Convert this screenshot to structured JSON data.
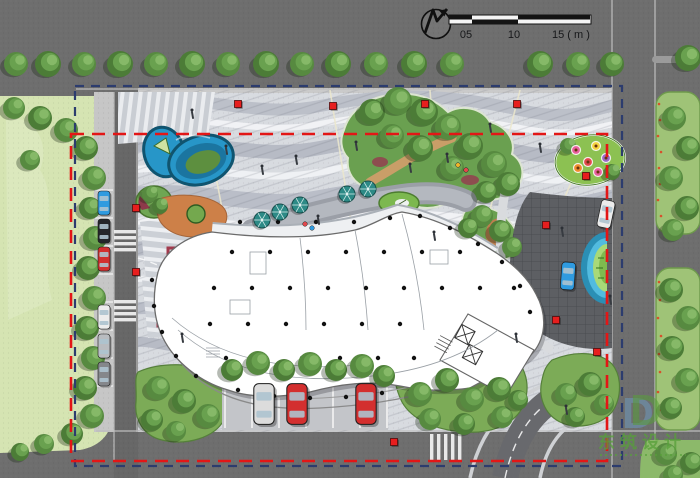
{
  "drawing": {
    "type": "landscape-site-plan-rendering",
    "north_arrow_icon": "stylized-N-arrow",
    "scalebar": {
      "labels": [
        "05",
        "10",
        "15 ( m )"
      ]
    },
    "logo": {
      "monogram": "D",
      "cn": "东筑设计"
    }
  },
  "palette": {
    "asphalt": "#6e6e6e",
    "lawn": "#d5e4b2",
    "plaza": "#d8dbe0",
    "wave_dark": "#b7bbc5",
    "wave_light": "#f1f2f5",
    "tree_green": "#4c7c37",
    "island_green": "#6aa050",
    "pond_blue": "#2796c8",
    "water_blue": "#52bbdf",
    "terracotta": "#cd8048",
    "planter_maroon": "#a23a4d",
    "boundary_red": "#e31616",
    "boundary_navy": "#2c3c6e",
    "marker_red": "#e71e1e",
    "umbrella_teal": "#2d8a86",
    "building_white": "#ffffff",
    "logo_green": "#57a03a",
    "logo_blue": "#6d8ba4"
  },
  "scene": {
    "trees": [
      [
        16,
        64,
        12
      ],
      [
        48,
        64,
        13
      ],
      [
        84,
        64,
        12
      ],
      [
        120,
        64,
        13
      ],
      [
        156,
        64,
        12
      ],
      [
        192,
        64,
        13
      ],
      [
        228,
        64,
        12
      ],
      [
        266,
        64,
        13
      ],
      [
        302,
        64,
        12
      ],
      [
        338,
        64,
        13
      ],
      [
        376,
        64,
        12
      ],
      [
        414,
        64,
        13
      ],
      [
        452,
        64,
        12
      ],
      [
        540,
        64,
        13
      ],
      [
        578,
        64,
        12
      ],
      [
        612,
        64,
        12
      ],
      [
        14,
        108,
        11
      ],
      [
        40,
        118,
        12
      ],
      [
        66,
        130,
        12
      ],
      [
        86,
        148,
        12
      ],
      [
        94,
        178,
        12
      ],
      [
        90,
        208,
        11
      ],
      [
        95,
        238,
        12
      ],
      [
        88,
        268,
        12
      ],
      [
        94,
        298,
        12
      ],
      [
        87,
        328,
        12
      ],
      [
        93,
        358,
        12
      ],
      [
        85,
        388,
        12
      ],
      [
        92,
        416,
        12
      ],
      [
        72,
        434,
        11
      ],
      [
        44,
        444,
        10
      ],
      [
        20,
        452,
        9
      ],
      [
        30,
        160,
        10
      ],
      [
        372,
        112,
        13
      ],
      [
        398,
        101,
        14
      ],
      [
        424,
        112,
        14
      ],
      [
        448,
        127,
        13
      ],
      [
        470,
        146,
        13
      ],
      [
        494,
        164,
        13
      ],
      [
        508,
        184,
        12
      ],
      [
        452,
        168,
        12
      ],
      [
        420,
        148,
        13
      ],
      [
        392,
        136,
        12
      ],
      [
        486,
        192,
        11
      ],
      [
        482,
        216,
        11
      ],
      [
        500,
        231,
        11
      ],
      [
        512,
        247,
        10
      ],
      [
        468,
        228,
        10
      ],
      [
        150,
        194,
        8
      ],
      [
        160,
        206,
        8
      ],
      [
        568,
        146,
        8
      ],
      [
        612,
        172,
        8
      ],
      [
        158,
        388,
        12
      ],
      [
        184,
        401,
        12
      ],
      [
        208,
        416,
        12
      ],
      [
        152,
        420,
        11
      ],
      [
        176,
        431,
        10
      ],
      [
        232,
        370,
        11
      ],
      [
        258,
        363,
        12
      ],
      [
        284,
        370,
        11
      ],
      [
        310,
        364,
        12
      ],
      [
        336,
        370,
        11
      ],
      [
        362,
        366,
        12
      ],
      [
        384,
        376,
        11
      ],
      [
        420,
        394,
        12
      ],
      [
        447,
        380,
        12
      ],
      [
        472,
        399,
        12
      ],
      [
        499,
        389,
        12
      ],
      [
        430,
        419,
        11
      ],
      [
        464,
        424,
        11
      ],
      [
        502,
        417,
        11
      ],
      [
        518,
        400,
        10
      ],
      [
        566,
        394,
        11
      ],
      [
        590,
        384,
        12
      ],
      [
        604,
        404,
        10
      ],
      [
        575,
        417,
        10
      ],
      [
        674,
        118,
        12
      ],
      [
        688,
        148,
        12
      ],
      [
        671,
        178,
        12
      ],
      [
        687,
        208,
        12
      ],
      [
        673,
        230,
        11
      ],
      [
        671,
        290,
        12
      ],
      [
        688,
        318,
        12
      ],
      [
        672,
        348,
        12
      ],
      [
        687,
        380,
        12
      ],
      [
        671,
        408,
        11
      ],
      [
        666,
        454,
        11
      ],
      [
        691,
        463,
        11
      ],
      [
        673,
        475,
        10
      ],
      [
        688,
        58,
        13
      ]
    ],
    "columns": [
      [
        232,
        252
      ],
      [
        270,
        252
      ],
      [
        308,
        252
      ],
      [
        346,
        252
      ],
      [
        384,
        252
      ],
      [
        422,
        252
      ],
      [
        460,
        252
      ],
      [
        214,
        288
      ],
      [
        252,
        288
      ],
      [
        290,
        288
      ],
      [
        328,
        288
      ],
      [
        366,
        288
      ],
      [
        404,
        288
      ],
      [
        442,
        288
      ],
      [
        480,
        288
      ],
      [
        514,
        288
      ],
      [
        210,
        324
      ],
      [
        248,
        324
      ],
      [
        286,
        324
      ],
      [
        324,
        324
      ],
      [
        362,
        324
      ],
      [
        400,
        324
      ],
      [
        226,
        358
      ],
      [
        264,
        358
      ],
      [
        302,
        358
      ],
      [
        340,
        358
      ],
      [
        378,
        358
      ],
      [
        414,
        358
      ],
      [
        240,
        222
      ],
      [
        278,
        222
      ],
      [
        316,
        222
      ],
      [
        354,
        222
      ],
      [
        390,
        218
      ],
      [
        420,
        216
      ],
      [
        450,
        228
      ],
      [
        478,
        244
      ],
      [
        502,
        262
      ],
      [
        520,
        286
      ],
      [
        530,
        312
      ],
      [
        238,
        390
      ],
      [
        274,
        396
      ],
      [
        310,
        398
      ],
      [
        346,
        397
      ],
      [
        382,
        393
      ],
      [
        416,
        386
      ],
      [
        446,
        376
      ],
      [
        196,
        376
      ],
      [
        176,
        356
      ],
      [
        162,
        332
      ],
      [
        154,
        306
      ],
      [
        152,
        280
      ]
    ],
    "markers": [
      [
        136,
        208
      ],
      [
        136,
        272
      ],
      [
        238,
        104
      ],
      [
        333,
        106
      ],
      [
        425,
        104
      ],
      [
        517,
        104
      ],
      [
        586,
        176
      ],
      [
        546,
        225
      ],
      [
        556,
        320
      ],
      [
        597,
        352
      ],
      [
        394,
        442
      ]
    ],
    "people": [
      [
        192,
        114
      ],
      [
        226,
        150
      ],
      [
        262,
        170
      ],
      [
        296,
        160
      ],
      [
        318,
        220
      ],
      [
        356,
        146
      ],
      [
        410,
        168
      ],
      [
        447,
        158
      ],
      [
        490,
        128
      ],
      [
        540,
        148
      ],
      [
        562,
        232
      ],
      [
        610,
        300
      ],
      [
        434,
        236
      ],
      [
        182,
        338
      ],
      [
        516,
        338
      ],
      [
        566,
        410
      ]
    ],
    "cyclists": [
      [
        305,
        224,
        "#e2484c"
      ],
      [
        312,
        228,
        "#2f9be0"
      ],
      [
        458,
        165,
        "#f0b429"
      ],
      [
        466,
        170,
        "#e2484c"
      ]
    ],
    "flowers": [
      [
        576,
        150,
        "#e85f9e"
      ],
      [
        596,
        146,
        "#f5d33f"
      ],
      [
        588,
        162,
        "#e2484c"
      ],
      [
        606,
        158,
        "#9a67c8"
      ],
      [
        578,
        168,
        "#f08c2e"
      ],
      [
        598,
        172,
        "#e85f9e"
      ]
    ],
    "speckles": [
      [
        659,
        104
      ],
      [
        660,
        120
      ],
      [
        658,
        136
      ],
      [
        661,
        152
      ],
      [
        659,
        168
      ],
      [
        660,
        184
      ],
      [
        658,
        200
      ],
      [
        661,
        216
      ],
      [
        659,
        282
      ],
      [
        660,
        300
      ],
      [
        658,
        318
      ],
      [
        661,
        336
      ],
      [
        659,
        354
      ],
      [
        660,
        372
      ],
      [
        658,
        392
      ],
      [
        661,
        410
      ]
    ],
    "umbrellas": [
      [
        280,
        212
      ],
      [
        300,
        205
      ],
      [
        347,
        194
      ],
      [
        368,
        189
      ],
      [
        262,
        220
      ]
    ],
    "cars": [
      [
        104,
        203,
        0,
        "#2f9be0",
        1
      ],
      [
        104,
        231,
        0,
        "#24262a",
        1
      ],
      [
        104,
        259,
        0,
        "#d32f2f",
        1
      ],
      [
        104,
        317,
        0,
        "#ececec",
        1
      ],
      [
        104,
        346,
        0,
        "#b9bcc0",
        1
      ],
      [
        104,
        374,
        0,
        "#85878b",
        1
      ],
      [
        264,
        404,
        0,
        "#dcdcdc",
        1.7
      ],
      [
        297,
        404,
        0,
        "#d32f2f",
        1.7
      ],
      [
        366,
        404,
        0,
        "#d32f2f",
        1.7
      ],
      [
        606,
        214,
        12,
        "#ececec",
        1.15
      ],
      [
        568,
        276,
        4,
        "#2f9be0",
        1.15
      ]
    ]
  }
}
